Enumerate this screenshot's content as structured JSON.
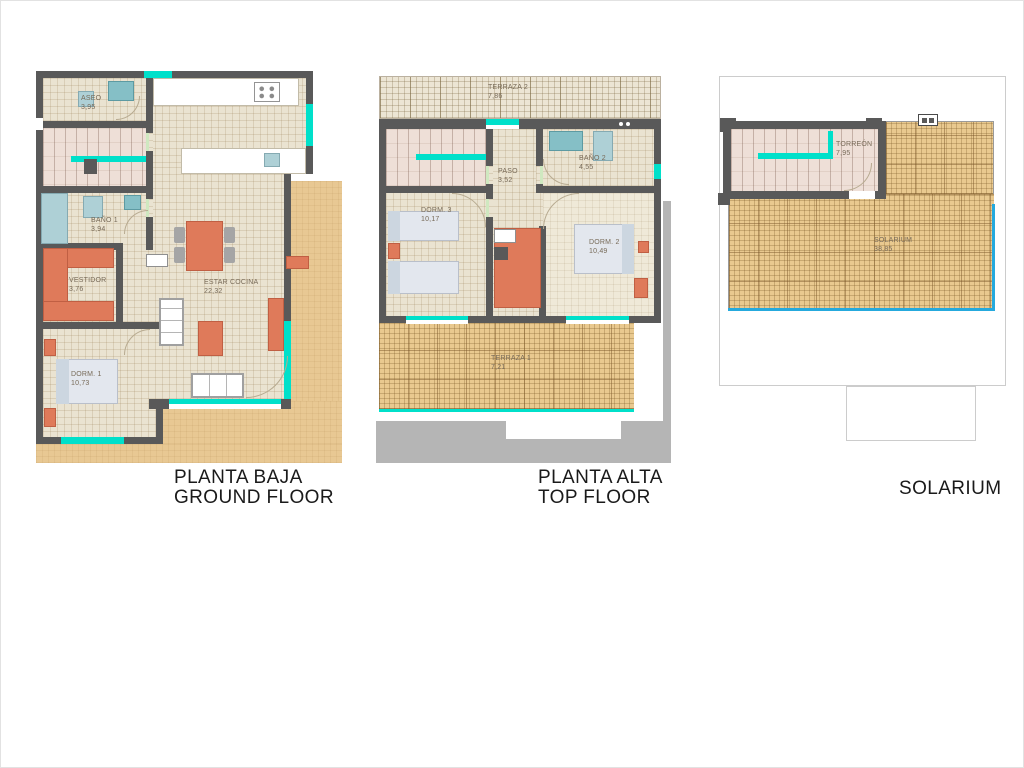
{
  "canvas": {
    "width": 1024,
    "height": 768,
    "background": "#ffffff"
  },
  "colors": {
    "wall": "#595959",
    "floor_tile": "#eae3d1",
    "floor_pink": "#eedfd7",
    "terrace_tan": "#e9c98f",
    "terrace_light": "#ece5d4",
    "window_cyan": "#00e0ca",
    "furniture_orange": "#df7a5a",
    "fixture_teal": "#85bfc6",
    "fixture_blue": "#aed0d6",
    "bed_light": "#e3e7ee",
    "furniture_gray": "#a5a5a5",
    "shadow_gray": "#b5b5b5",
    "pool_edge_blue": "#25a9dd",
    "room_label_text": "#776a58",
    "title_text": "#1a1a1a"
  },
  "plans": {
    "ground": {
      "title_line1": "PLANTA BAJA",
      "title_line2": "GROUND FLOOR",
      "rooms": {
        "aseo": {
          "name": "ASEO",
          "area": "3,95"
        },
        "bano1": {
          "name": "BAÑO 1",
          "area": "3,94"
        },
        "vestidor": {
          "name": "VESTIDOR",
          "area": "3,76"
        },
        "dorm1": {
          "name": "DORM. 1",
          "area": "10,73"
        },
        "estar_cocina": {
          "name": "ESTAR COCINA",
          "area": "22,32"
        }
      }
    },
    "top": {
      "title_line1": "PLANTA ALTA",
      "title_line2": "TOP FLOOR",
      "rooms": {
        "terraza2": {
          "name": "TERRAZA 2",
          "area": "7,86"
        },
        "paso": {
          "name": "PASO",
          "area": "3,52"
        },
        "bano2": {
          "name": "BAÑO 2",
          "area": "4,55"
        },
        "dorm3": {
          "name": "DORM. 3",
          "area": "10,17"
        },
        "dorm2": {
          "name": "DORM. 2",
          "area": "10,49"
        },
        "terraza1": {
          "name": "TERRAZA 1",
          "area": "7,21"
        }
      }
    },
    "solarium": {
      "title_line1": "SOLARIUM",
      "rooms": {
        "torreon": {
          "name": "TORREÓN",
          "area": "7,95"
        },
        "solarium": {
          "name": "SOLARIUM",
          "area": "38,85"
        }
      }
    }
  }
}
